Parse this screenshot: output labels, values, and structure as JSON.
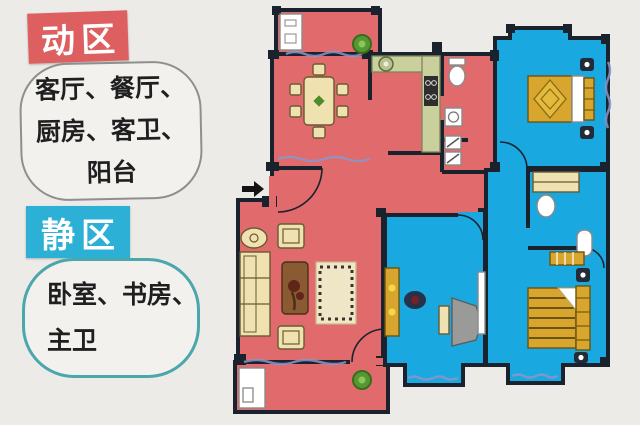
{
  "colors": {
    "page_bg": "#edebe8",
    "badge_active": "#dd5f5f",
    "badge_quiet": "#2cb0d6",
    "badge_text": "#ffffff",
    "bubble_bg": "#f2f1ee",
    "bubble_active_border": "#8f8f8f",
    "bubble_quiet_border": "#4ba7ab",
    "text_dark": "#1f1f1f",
    "active_room": "#e16a6c",
    "quiet_room": "#19a8e0",
    "wall": "#1a222e",
    "furniture_cream": "#efe2b0",
    "furniture_gold": "#d8a62e",
    "counter_green": "#c9d09e",
    "plant_green": "#55982f",
    "window_line": "#8b95c9",
    "table_brown": "#8a5a33",
    "desk_gray": "#9a9a98"
  },
  "legend": {
    "active_zone": {
      "badge": "动区",
      "lines": [
        "客厅、餐厅、",
        "厨房、客卫、",
        "阳台"
      ]
    },
    "quiet_zone": {
      "badge": "静区",
      "lines": [
        "卧室、书房、",
        "主卫"
      ]
    }
  }
}
